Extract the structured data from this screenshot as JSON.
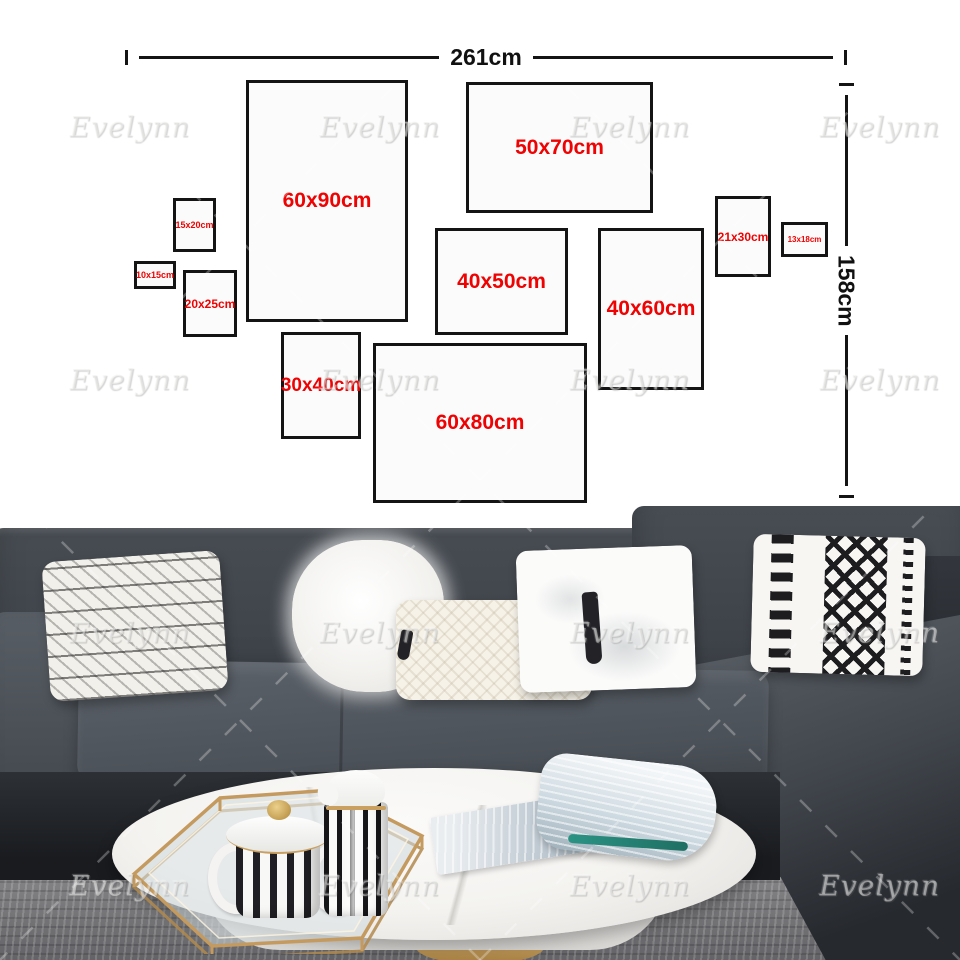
{
  "product": {
    "type": "wall-art-size-guide",
    "wall_width_label": "261cm",
    "wall_height_label": "158cm"
  },
  "watermark": {
    "text": "Evelynn"
  },
  "colors": {
    "accent_red": "#ee0202",
    "annotation_black": "#141414",
    "wall_gray": "#d7d7d3",
    "sofa_gray": "#43484e",
    "gold": "#c49a5e",
    "teal": "#2a8f80"
  },
  "frames": [
    {
      "label": "60x90cm",
      "x": 246,
      "y": 80,
      "w": 162,
      "h": 242,
      "fs": 21
    },
    {
      "label": "50x70cm",
      "x": 466,
      "y": 82,
      "w": 187,
      "h": 131,
      "fs": 21
    },
    {
      "label": "15x20cm",
      "x": 173,
      "y": 198,
      "w": 43,
      "h": 54,
      "fs": 9
    },
    {
      "label": "10x15cm",
      "x": 134,
      "y": 261,
      "w": 42,
      "h": 28,
      "fs": 9
    },
    {
      "label": "20x25cm",
      "x": 183,
      "y": 270,
      "w": 54,
      "h": 67,
      "fs": 12
    },
    {
      "label": "40x50cm",
      "x": 435,
      "y": 228,
      "w": 133,
      "h": 107,
      "fs": 21
    },
    {
      "label": "40x60cm",
      "x": 598,
      "y": 228,
      "w": 106,
      "h": 162,
      "fs": 21
    },
    {
      "label": "21x30cm",
      "x": 715,
      "y": 196,
      "w": 56,
      "h": 81,
      "fs": 12
    },
    {
      "label": "13x18cm",
      "x": 781,
      "y": 222,
      "w": 47,
      "h": 35,
      "fs": 8
    },
    {
      "label": "30x40cm",
      "x": 281,
      "y": 332,
      "w": 80,
      "h": 107,
      "fs": 19
    },
    {
      "label": "60x80cm",
      "x": 373,
      "y": 343,
      "w": 214,
      "h": 160,
      "fs": 21
    }
  ],
  "watermark_grid": {
    "xs": [
      130,
      380,
      630,
      880
    ],
    "ys": [
      127,
      380,
      633,
      886
    ]
  }
}
